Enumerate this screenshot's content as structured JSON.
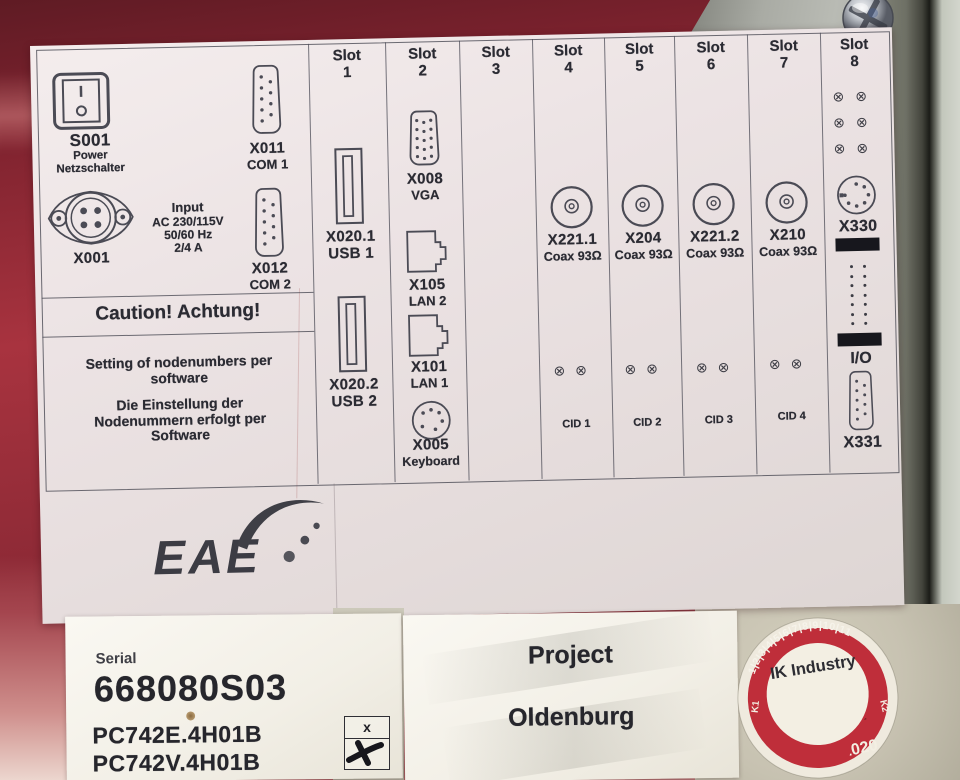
{
  "left": {
    "s001_id": "S001",
    "s001_sub1": "Power",
    "s001_sub2": "Netzschalter",
    "x011_id": "X011",
    "x011_sub": "COM 1",
    "x001_id": "X001",
    "input_title": "Input",
    "input_l1": "AC 230/115V",
    "input_l2": "50/60 Hz",
    "input_l3": "2/4 A",
    "x012_id": "X012",
    "x012_sub": "COM 2",
    "caution": "Caution! Achtung!",
    "note_en1": "Setting of nodenumbers per",
    "note_en2": "software",
    "note_de1": "Die Einstellung der",
    "note_de2": "Nodenummern erfolgt per",
    "note_de3": "Software"
  },
  "slots": {
    "header_word": "Slot",
    "numbers": [
      "1",
      "2",
      "3",
      "4",
      "5",
      "6",
      "7",
      "8"
    ],
    "slot1": {
      "c1_id": "X020.1",
      "c1_sub": "USB 1",
      "c2_id": "X020.2",
      "c2_sub": "USB 2"
    },
    "slot2": {
      "c1_id": "X008",
      "c1_sub": "VGA",
      "c2_id": "X105",
      "c2_sub": "LAN 2",
      "c3_id": "X101",
      "c3_sub": "LAN 1",
      "c4_id": "X005",
      "c4_sub": "Keyboard"
    },
    "slot4": {
      "id": "X221.1",
      "sub": "Coax 93Ω",
      "cid": "CID 1"
    },
    "slot5": {
      "id": "X204",
      "sub": "Coax 93Ω",
      "cid": "CID 2"
    },
    "slot6": {
      "id": "X221.2",
      "sub": "Coax 93Ω",
      "cid": "CID 3"
    },
    "slot7": {
      "id": "X210",
      "sub": "Coax 93Ω",
      "cid": "CID 4"
    },
    "slot8": {
      "din_id": "X330",
      "io_label": "I/O",
      "db9_id": "X331"
    }
  },
  "logo": {
    "text": "EAE"
  },
  "bottom": {
    "serial_label": "Serial",
    "serial_number": "668080S03",
    "model1": "PC742E.4H01B",
    "model2": "PC742V.4H01B",
    "checkbox_mark": "x",
    "project_label": "Project",
    "project_name": "Oldenburg"
  },
  "badge": {
    "rim_numbers": "1|2|3|4|5|6|7|8|9|10|11",
    "company": "IK Industry",
    "banner": "Elektrisch Geprüft",
    "tel_line1": "Tel: 0049 2182",
    "tel_line2": "8969785",
    "year_left": "2",
    "year_right": "/ 2020",
    "left_mark": "K1",
    "right_mark": "K2"
  },
  "colors": {
    "machine_red": "#8f2433",
    "sticker_red": "#bf2e3a",
    "label_bg": "#ece4e4"
  }
}
